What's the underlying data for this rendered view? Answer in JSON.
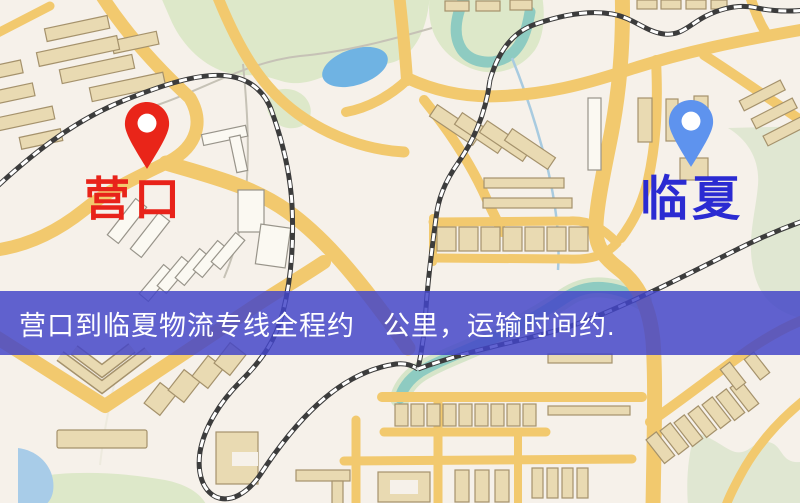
{
  "origin_marker": {
    "label": "营口",
    "icon": "map-pin",
    "pin_color": "#e92519",
    "label_color": "#e8231a"
  },
  "destination_marker": {
    "label": "临夏",
    "icon": "map-pin",
    "pin_color": "#5e93ee",
    "label_color": "#2b2bd2"
  },
  "banner": {
    "text": "营口到临夏物流专线全程约　公里，运输时间约.",
    "background_color": "#4345c8",
    "text_color": "#ffffff"
  },
  "map_colors": {
    "land": "#f6f1ea",
    "road": "#f2c96e",
    "building": "#e9dab2",
    "park": "#dde8c9",
    "pond": "#6fb3e3",
    "river": "#8ecbc1",
    "railway": "#3c3c3c"
  }
}
